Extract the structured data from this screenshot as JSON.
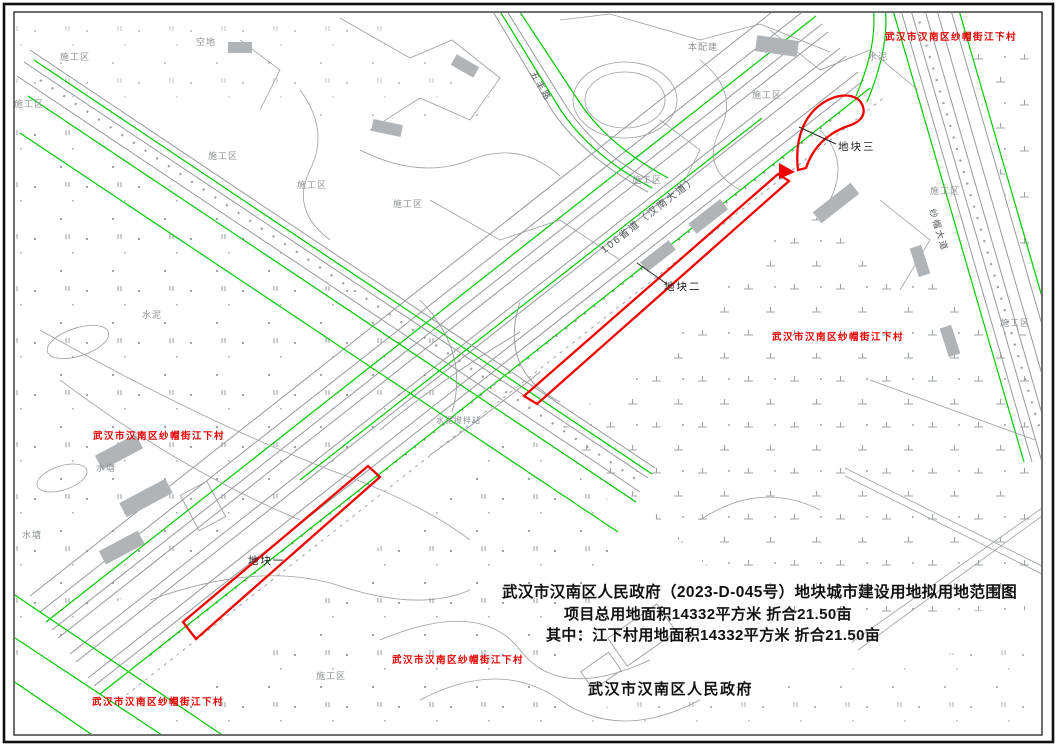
{
  "title_block": {
    "line1": "武汉市汉南区人民政府（2023-D-045号）地块城市建设用地拟用地范围图",
    "line2": "项目总用地面积14332平方米  折合21.50亩",
    "line3": "其中：江下村用地面积14332平方米  折合21.50亩",
    "signature": "武汉市汉南区人民政府"
  },
  "village_label": "武汉市汉南区纱帽街江下村",
  "parcel_labels": [
    {
      "text": "地块一"
    },
    {
      "text": "地块二"
    },
    {
      "text": "地块三"
    }
  ],
  "road_labels": [
    {
      "text": "106省道（汉南大道）"
    },
    {
      "text": "五丰路"
    },
    {
      "text": "纱帽大道"
    }
  ],
  "area_labels": [
    {
      "text": "施工区"
    },
    {
      "text": "施工区"
    },
    {
      "text": "施工区"
    },
    {
      "text": "施工区"
    },
    {
      "text": "施工区"
    },
    {
      "text": "施工区"
    },
    {
      "text": "施工区"
    },
    {
      "text": "施工区"
    },
    {
      "text": "施工区"
    },
    {
      "text": "施工区"
    },
    {
      "text": "空地"
    },
    {
      "text": "水泥"
    },
    {
      "text": "水泥"
    },
    {
      "text": "水塘"
    },
    {
      "text": "水塘"
    },
    {
      "text": "本配建"
    },
    {
      "text": "水泥搅拌站"
    }
  ],
  "colors": {
    "parcel_red": "#f00000",
    "boundary_green": "#00c800",
    "linework_gray": "#969a9c",
    "text_black": "#111111"
  }
}
